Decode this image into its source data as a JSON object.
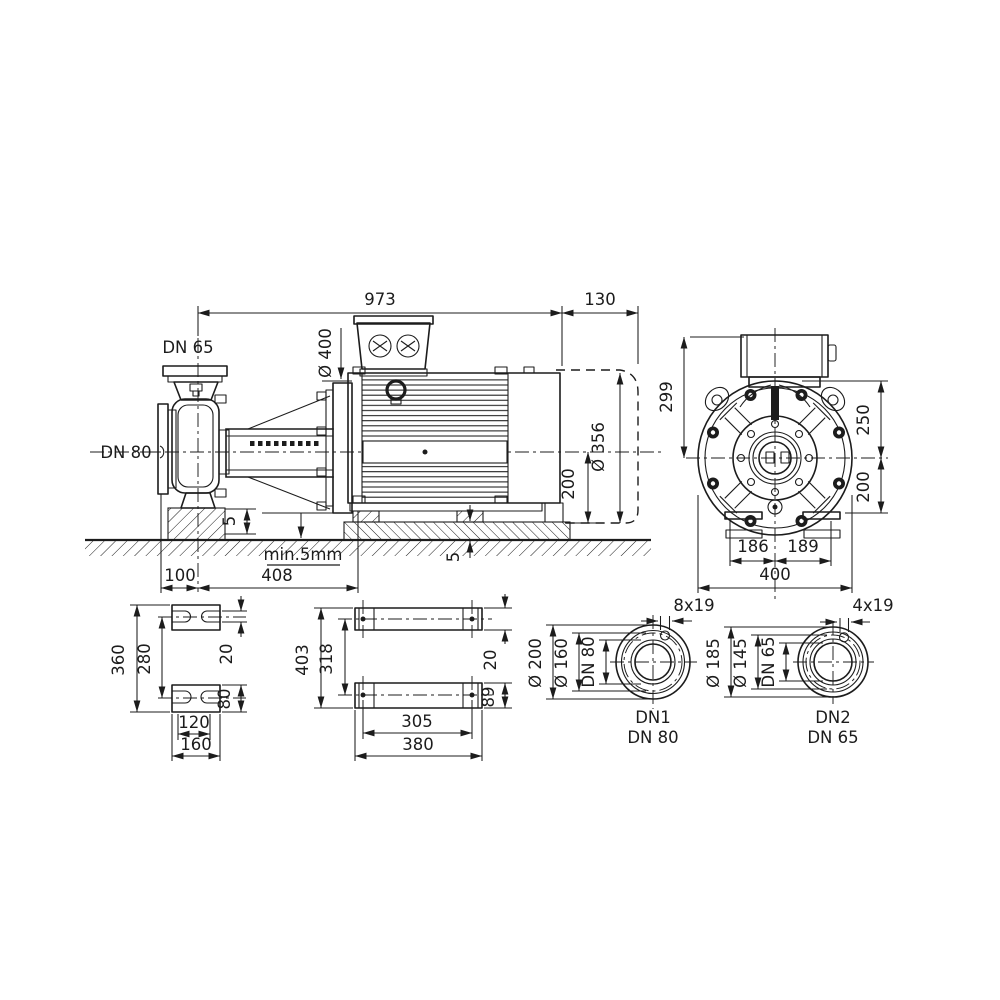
{
  "drawing": {
    "ink": "#1c1c1c",
    "background": "#ffffff",
    "side_view": {
      "overall_length": "973",
      "extension_length": "130",
      "flange_diameter": "Ø 400",
      "discharge_port": "DN 65",
      "suction_port": "DN 80",
      "motor_diameter": "Ø 356",
      "shaft_height": "200",
      "pad_height": "5",
      "grout_note": "min.5mm",
      "suction_offset": "100",
      "foot_distance": "408",
      "foot_pad_height": "5"
    },
    "front_view": {
      "height_to_box": "299",
      "upper_half": "250",
      "lower_half": "200",
      "foot_left": "186",
      "foot_right": "189",
      "overall_width": "400"
    },
    "pump_foot_plan": {
      "overall_length": "360",
      "hole_pitch": "280",
      "slot_width": "20",
      "pad_width": "80",
      "hole_span": "120",
      "overall_width": "160"
    },
    "motor_foot_plan": {
      "overall_length": "403",
      "hole_pitch": "318",
      "slot_width": "20",
      "pad_width": "89",
      "hole_span": "305",
      "overall_width": "380"
    },
    "flange_dn1": {
      "bolt_holes": "8x19",
      "outer_diameter": "Ø 200",
      "bolt_circle": "Ø 160",
      "nominal_bore": "DN 80",
      "port_id": "DN1",
      "port_size": "DN 80"
    },
    "flange_dn2": {
      "bolt_holes": "4x19",
      "outer_diameter": "Ø 185",
      "bolt_circle": "Ø 145",
      "nominal_bore": "DN 65",
      "port_id": "DN2",
      "port_size": "DN 65"
    }
  }
}
